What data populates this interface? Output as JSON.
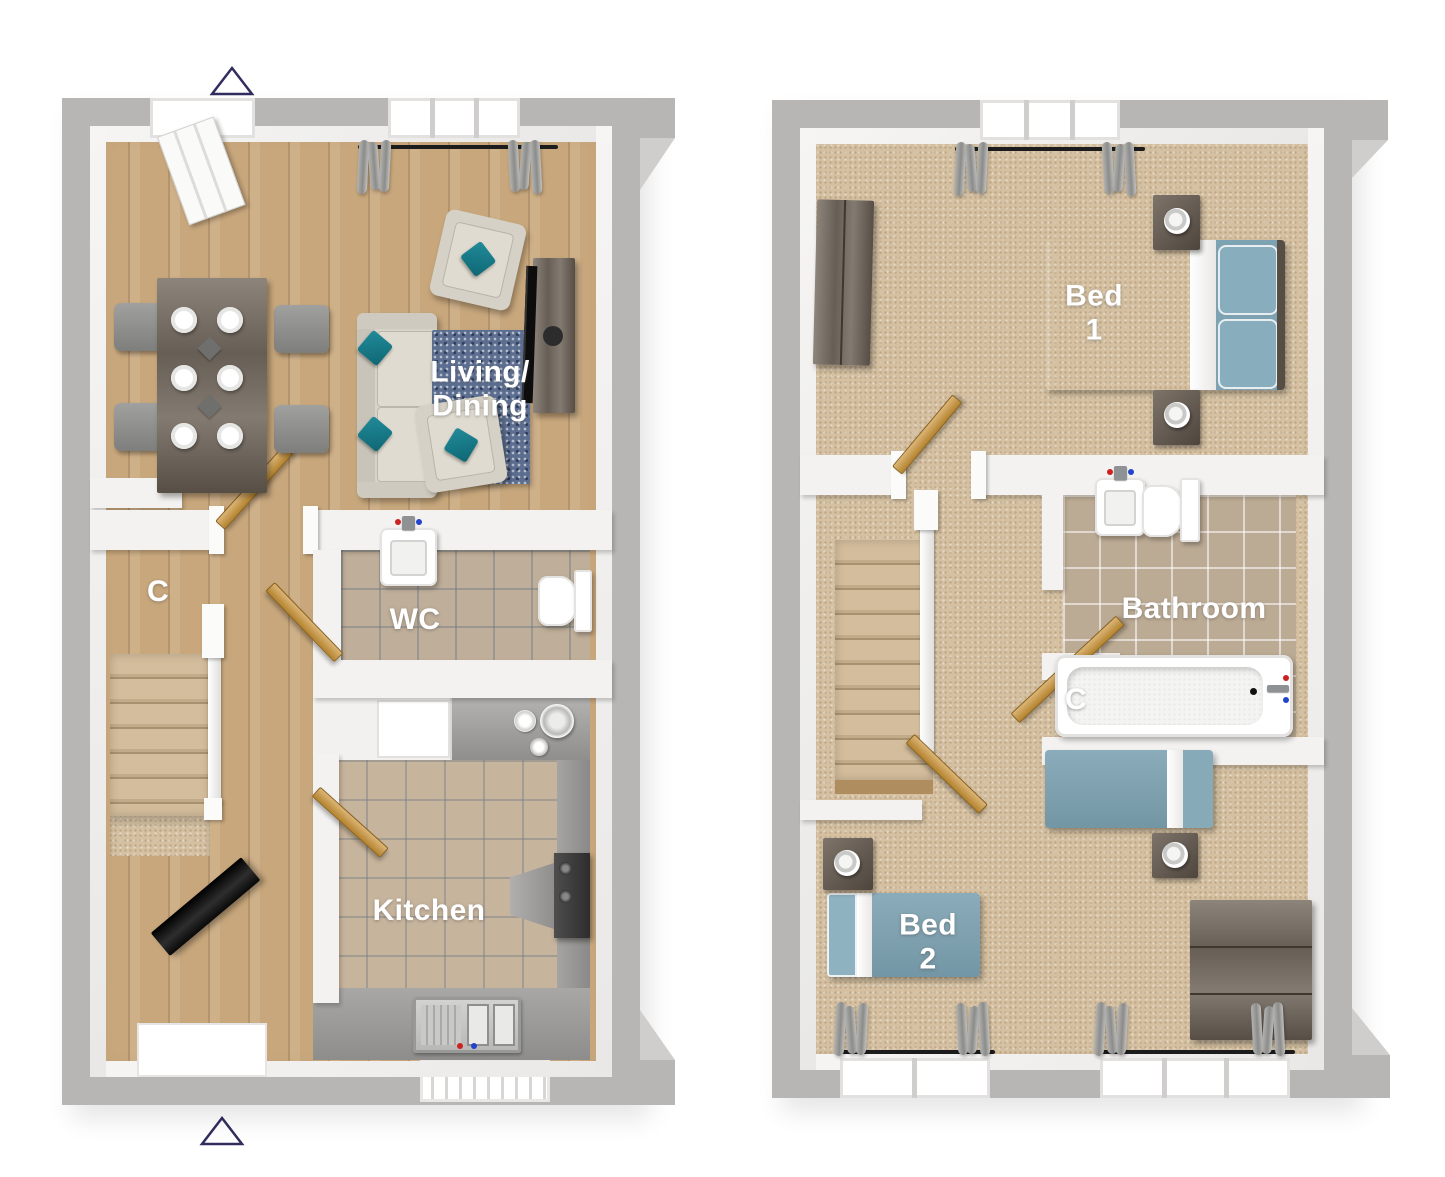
{
  "document": {
    "kind": "3D floor plan rendering, two floors side by side",
    "background": "#ffffff"
  },
  "palette": {
    "outer_wall_gray": "#b7b6b4",
    "inner_wall_white": "#f3f2f0",
    "wood_floor": "#c8a77c",
    "carpet": "#d5c1a2",
    "tile_beige": "#bfae99",
    "counter_gray": "#9b9a99",
    "accent_teal": "#17808f",
    "bed_blue": "#7ea4b3",
    "rug_navy": "#5c6e90",
    "dark_wood": "#675e55",
    "door_wood": "#c08f46",
    "marker_navy": "#312d5e"
  },
  "markers": {
    "top_triangle": "entrance-marker",
    "bottom_triangle": "entrance-marker"
  },
  "ground_floor": {
    "rooms": {
      "living_dining": {
        "label_line1": "Living/",
        "label_line2": "Dining"
      },
      "wc": {
        "label": "WC"
      },
      "kitchen": {
        "label": "Kitchen"
      },
      "cupboard": {
        "label": "C"
      }
    }
  },
  "first_floor": {
    "rooms": {
      "bed1": {
        "label_line1": "Bed",
        "label_line2": "1"
      },
      "bathroom": {
        "label": "Bathroom"
      },
      "cupboard": {
        "label": "C"
      },
      "bed2": {
        "label_line1": "Bed",
        "label_line2": "2"
      }
    }
  }
}
